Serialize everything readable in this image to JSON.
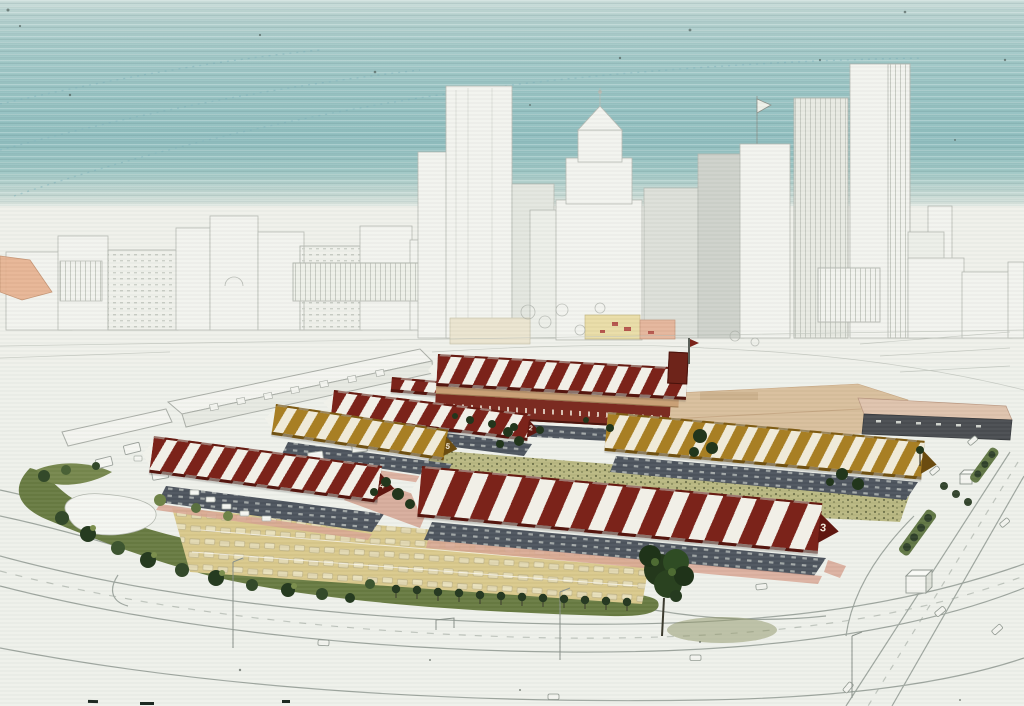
{
  "scene": {
    "type": "architectural-aerial-rendering",
    "subject": "market-district-with-striped-sheds-and-downtown-skyline"
  },
  "sheds": [
    {
      "id": "shed-2",
      "label": "2",
      "roof": "red-striped"
    },
    {
      "id": "shed-3",
      "label": "3",
      "roof": "red-striped"
    },
    {
      "id": "shed-4",
      "label": "4",
      "roof": "red-striped"
    },
    {
      "id": "shed-5",
      "label": "5",
      "roof": "gold-striped"
    },
    {
      "id": "shed-hall",
      "label": "",
      "roof": "red-striped"
    },
    {
      "id": "shed-east",
      "label": "",
      "roof": "gold-striped"
    }
  ],
  "palette": {
    "sky_teal": "#96c2c2",
    "paper": "#eef0ea",
    "roof_red": "#7b231a",
    "roof_gold": "#a87f24",
    "stripe_white": "#f1efe7",
    "gable_red": "#5f1710",
    "gable_gold": "#6b4c10",
    "tree_dark": "#263a1f",
    "tree_light": "#7c8f4e",
    "green_belt": "#66793f",
    "parking_tan": "#d9c88a",
    "plaza_tan": "#d8be9b",
    "walkway_pink": "#d8a592",
    "shadow_band": "#4a515b",
    "sketch_line": "#a9ada6"
  }
}
